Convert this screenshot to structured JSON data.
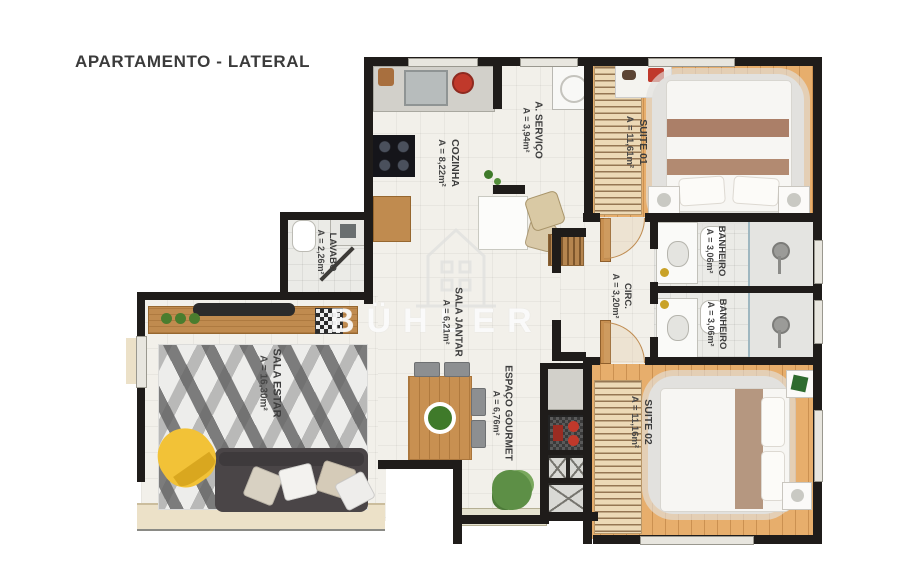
{
  "title": "APARTAMENTO - LATERAL",
  "watermark": {
    "brand": "BÜHLER"
  },
  "rooms": {
    "cozinha": {
      "name": "COZINHA",
      "area": "A = 8,22m²"
    },
    "servico": {
      "name": "A. SERVIÇO",
      "area": "A = 3,94m²"
    },
    "suite01": {
      "name": "SUITE 01",
      "area": "A = 11,61m²"
    },
    "banheiro1": {
      "name": "BANHEIRO",
      "area": "A = 3,06m²"
    },
    "banheiro2": {
      "name": "BANHEIRO",
      "area": "A = 3,06m²"
    },
    "lavabo": {
      "name": "LAVABO",
      "area": "A = 2,26m²"
    },
    "jantar": {
      "name": "SALA JANTAR",
      "area": "A = 6,21m²"
    },
    "circ": {
      "name": "CIRC.",
      "area": "A = 3,20m²"
    },
    "estar": {
      "name": "SALA ESTAR",
      "area": "A = 16,30m²"
    },
    "gourmet": {
      "name": "ESPAÇO GOURMET",
      "area": "A = 6,76m²"
    },
    "suite02": {
      "name": "SUITE 02",
      "area": "A = 11,16m²"
    }
  },
  "palette": {
    "wall": "#1f1c1a",
    "wood_floor": "#e7ae6c",
    "tile_floor": "#f2f0ea",
    "sofa": "#4a4547",
    "armchair_yellow": "#f2c237",
    "accent_red": "#c0392b"
  }
}
